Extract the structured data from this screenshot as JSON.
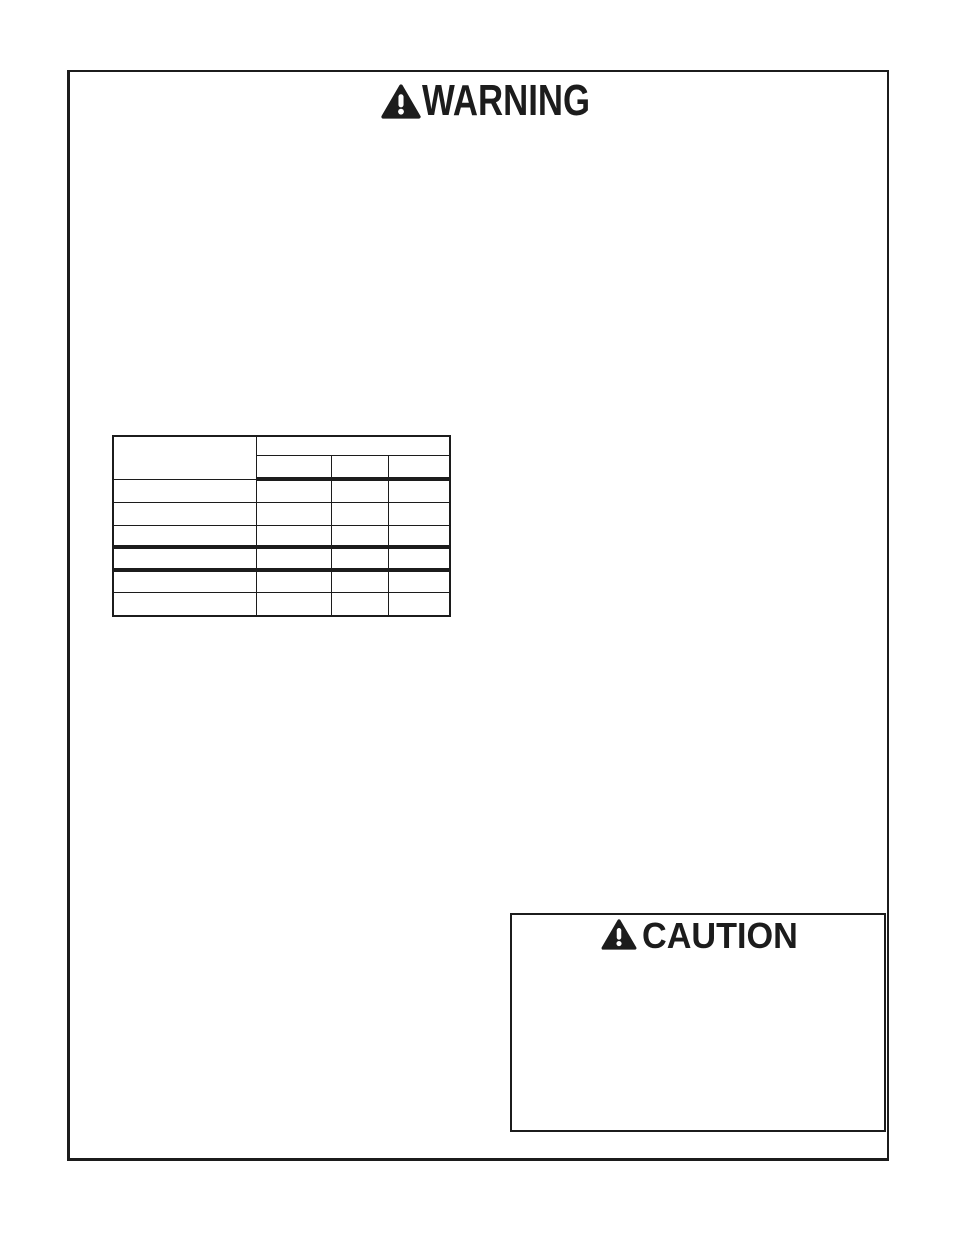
{
  "document": {
    "warning": {
      "title": "WARNING",
      "icon": "safety-alert-triangle"
    },
    "caution": {
      "title": "CAUTION",
      "icon": "safety-alert-triangle"
    },
    "colors": {
      "ink": "#1c1c1c",
      "paper": "#ffffff"
    }
  }
}
